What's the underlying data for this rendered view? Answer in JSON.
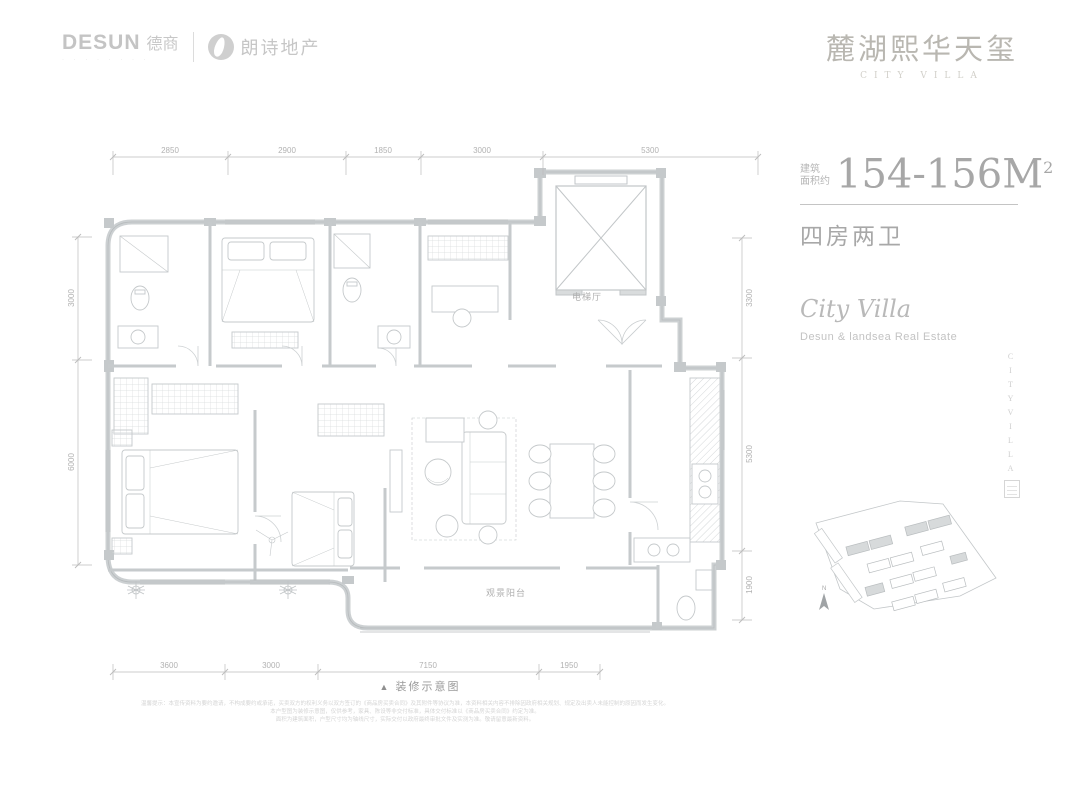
{
  "header": {
    "desun_en": "DESUN",
    "desun_cn": "德商",
    "desun_sub": "· · · · · · · ·",
    "landsea_cn": "朗诗地产",
    "brand_title": "麓湖熙华天玺",
    "brand_subtitle": "CITY VILLA"
  },
  "info": {
    "area_prefix_line1": "建筑",
    "area_prefix_line2": "面积约",
    "area_value": "154-156M",
    "area_sup": "2",
    "rooms": "四房两卫",
    "tagline": "City Villa",
    "tagline_sub": "Desun & landsea Real Estate",
    "vertical_text": "CITYVILLA"
  },
  "plan": {
    "caption_icon": "▲",
    "caption": "装修示意图",
    "labels": {
      "elevator_hall": "电梯厅",
      "balcony": "观景阳台"
    },
    "dims_top": [
      "2850",
      "2900",
      "1850",
      "3000",
      "5300"
    ],
    "dims_left": [
      "3000",
      "6000"
    ],
    "dims_right": [
      "3300",
      "5300",
      "1900"
    ],
    "dims_bottom": [
      "3600",
      "3000",
      "7150",
      "1950"
    ],
    "north_label": "N"
  },
  "disclaimer": {
    "line1": "温馨提示：本宣传资料为要约邀请，不构成要约或承诺，买卖双方的权利义务以双方签订的《商品房买卖合同》及其附件等协议为准，本资料相关内容不排除因政府相关规划、规定及出卖人未能控制的原因而发生变化。",
    "line2": "本户型图为装修示意图，仅供参考，家具、陈设等非交付标准，具体交付标准以《商品房买卖合同》约定为准。",
    "line3": "面积为建筑面积，户型尺寸均为轴线尺寸，实际交付以政府最终审批文件及实测为准。敬请留意最新资料。"
  }
}
